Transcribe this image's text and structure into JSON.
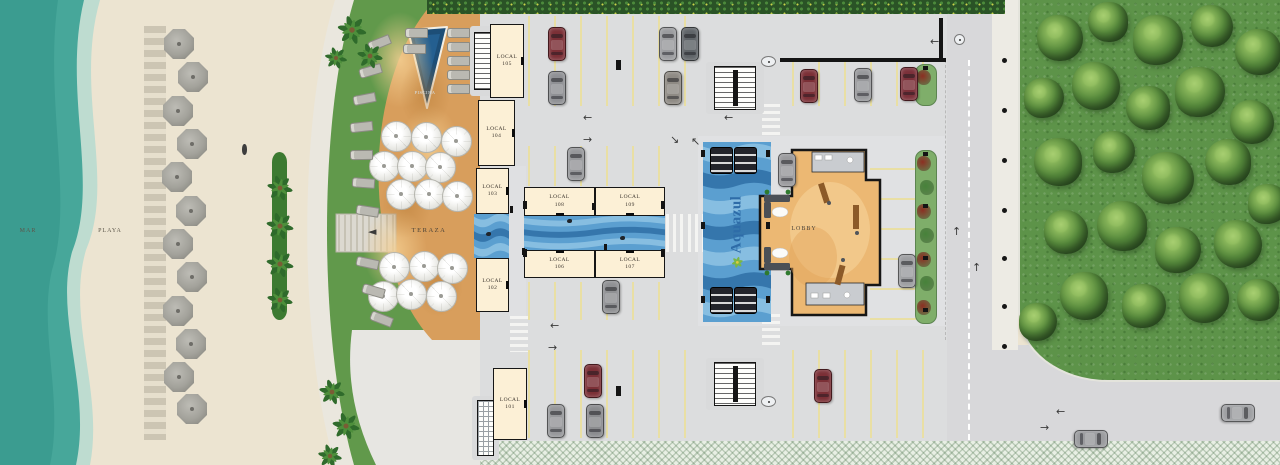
{
  "labels": {
    "sea": "MAR",
    "beach": "PLAYA",
    "terrace": "TERAZA",
    "pool": "PISCINA",
    "lobby": "LOBBY",
    "brand": "Aquazul"
  },
  "colors": {
    "sand": "#ece4d1",
    "seaFoam": "#bedcd0",
    "sea": "#47a79a",
    "seaDeep": "#3b9c90",
    "grass": "#61994b",
    "walkway": "#eae7de",
    "pavement": "#e7e6e2",
    "terrace": "#d89e5c",
    "terraceLight": "#f4cd92",
    "terraceDark": "#c08034",
    "poolTri": "#1d4e77",
    "poolEdge": "#f2efe6",
    "cream": "#fcf0d6",
    "wall": "#161616",
    "asphalt": "#dcddde",
    "stall": "#e9dfa4",
    "waterBase": "#5b9fd0",
    "waveLight": "#8fc3e4",
    "waveDark": "#2f6ea6",
    "lobbyFloor": "#ecb873",
    "lobbySwirl": "#f4cd92",
    "bath": "#c9ccd0",
    "sofa": "#4b5056",
    "wood": "#8c5a28",
    "road": "#d8d8da",
    "sidewalkC": "#edebe4",
    "lawnC": "#5d9349",
    "brandBlue": "#2e6ca8",
    "brandGreen": "#7ab648",
    "brandYellow": "#e2c93f",
    "umbGray": "#a3a29b",
    "treeDark": "#2c5524",
    "treeMid": "#55883b",
    "treeLight": "#8cb95c",
    "planter": "#7fae6a",
    "flowerRed": "#8c2f22",
    "flowerGreen": "#47823a"
  },
  "locals": [
    {
      "name": "LOCAL",
      "num": "105",
      "x": 490,
      "y": 24,
      "w": 34,
      "h": 74,
      "door": "right"
    },
    {
      "name": "LOCAL",
      "num": "104",
      "x": 478,
      "y": 100,
      "w": 37,
      "h": 66,
      "door": "right"
    },
    {
      "name": "LOCAL",
      "num": "103",
      "x": 476,
      "y": 168,
      "w": 33,
      "h": 46,
      "door": "right"
    },
    {
      "name": "LOCAL",
      "num": "102",
      "x": 476,
      "y": 258,
      "w": 33,
      "h": 54,
      "door": "right"
    },
    {
      "name": "LOCAL",
      "num": "101",
      "x": 493,
      "y": 368,
      "w": 34,
      "h": 72,
      "door": "right"
    },
    {
      "name": "LOCAL",
      "num": "108",
      "x": 524,
      "y": 187,
      "w": 71,
      "h": 29,
      "door": "bottom"
    },
    {
      "name": "LOCAL",
      "num": "109",
      "x": 595,
      "y": 187,
      "w": 70,
      "h": 29,
      "door": "bottom"
    },
    {
      "name": "LOCAL",
      "num": "106",
      "x": 524,
      "y": 250,
      "w": 71,
      "h": 28,
      "door": "top"
    },
    {
      "name": "LOCAL",
      "num": "107",
      "x": 595,
      "y": 250,
      "w": 70,
      "h": 28,
      "door": "top"
    }
  ],
  "scene": {
    "water": [
      {
        "x": 474,
        "y": 214,
        "w": 35,
        "h": 44,
        "bands": 3
      },
      {
        "x": 524,
        "y": 216,
        "w": 141,
        "h": 34,
        "bands": 3
      },
      {
        "x": 703,
        "y": 142,
        "w": 68,
        "h": 180,
        "bands": 7
      }
    ],
    "stalls": [
      {
        "x": 528,
        "y": 16,
        "w": 178,
        "h": 90,
        "gap": 26,
        "dir": 90
      },
      {
        "x": 792,
        "y": 62,
        "w": 152,
        "h": 44,
        "gap": 26,
        "dir": 90
      },
      {
        "x": 528,
        "y": 146,
        "w": 138,
        "h": 40,
        "gap": 26,
        "dir": 90
      },
      {
        "x": 528,
        "y": 282,
        "w": 138,
        "h": 38,
        "gap": 26,
        "dir": 90
      },
      {
        "x": 528,
        "y": 350,
        "w": 178,
        "h": 88,
        "gap": 26,
        "dir": 90
      },
      {
        "x": 792,
        "y": 350,
        "w": 152,
        "h": 88,
        "gap": 26,
        "dir": 90
      },
      {
        "x": 870,
        "y": 152,
        "w": 46,
        "h": 168,
        "gap": 30,
        "dir": 0
      }
    ],
    "crosswalks": [
      {
        "x": 762,
        "y": 104,
        "w": 18,
        "h": 34,
        "dir": "h"
      },
      {
        "x": 762,
        "y": 314,
        "w": 18,
        "h": 32,
        "dir": "h"
      },
      {
        "x": 510,
        "y": 316,
        "w": 18,
        "h": 36,
        "dir": "h"
      },
      {
        "x": 666,
        "y": 214,
        "w": 17,
        "h": 38,
        "dir": "v"
      },
      {
        "x": 688,
        "y": 214,
        "w": 17,
        "h": 38,
        "dir": "v"
      }
    ],
    "stairs": [
      {
        "x": 474,
        "y": 32,
        "w": 18,
        "h": 58,
        "type": "treads",
        "px": 470,
        "py": 26,
        "pw": 26,
        "ph": 70
      },
      {
        "x": 714,
        "y": 66,
        "w": 42,
        "h": 44,
        "type": "double",
        "px": 706,
        "py": 62,
        "pw": 58,
        "ph": 52
      },
      {
        "x": 714,
        "y": 362,
        "w": 42,
        "h": 44,
        "type": "double",
        "px": 706,
        "py": 358,
        "pw": 58,
        "ph": 52
      },
      {
        "x": 477,
        "y": 400,
        "w": 17,
        "h": 56,
        "type": "grid",
        "px": 472,
        "py": 396,
        "pw": 27,
        "ph": 64
      }
    ],
    "entry_markers": [
      {
        "x": 761,
        "y": 56,
        "w": 13,
        "h": 9
      },
      {
        "x": 761,
        "y": 396,
        "w": 13,
        "h": 9
      },
      {
        "x": 954,
        "y": 34,
        "w": 9,
        "h": 9
      }
    ],
    "posts": [
      {
        "x": 523,
        "y": 201,
        "w": 4,
        "h": 8
      },
      {
        "x": 523,
        "y": 249,
        "w": 4,
        "h": 8
      },
      {
        "x": 661,
        "y": 201,
        "w": 4,
        "h": 8
      },
      {
        "x": 661,
        "y": 249,
        "w": 4,
        "h": 8
      },
      {
        "x": 592,
        "y": 203,
        "w": 3,
        "h": 7
      },
      {
        "x": 604,
        "y": 244,
        "w": 3,
        "h": 7
      },
      {
        "x": 616,
        "y": 60,
        "w": 5,
        "h": 10
      },
      {
        "x": 616,
        "y": 386,
        "w": 5,
        "h": 10
      },
      {
        "x": 510,
        "y": 206,
        "w": 3,
        "h": 7
      },
      {
        "x": 522,
        "y": 248,
        "w": 3,
        "h": 7
      },
      {
        "x": 780,
        "y": 58,
        "w": 166,
        "h": 4
      },
      {
        "x": 939,
        "y": 18,
        "w": 4,
        "h": 42
      },
      {
        "x": 701,
        "y": 150,
        "w": 4,
        "h": 7
      },
      {
        "x": 701,
        "y": 296,
        "w": 4,
        "h": 7
      },
      {
        "x": 766,
        "y": 150,
        "w": 4,
        "h": 7
      },
      {
        "x": 766,
        "y": 296,
        "w": 4,
        "h": 7
      },
      {
        "x": 701,
        "y": 222,
        "w": 4,
        "h": 7
      },
      {
        "x": 766,
        "y": 222,
        "w": 4,
        "h": 7
      }
    ],
    "benches": [
      {
        "x": 710,
        "y": 147
      },
      {
        "x": 734,
        "y": 147
      },
      {
        "x": 710,
        "y": 287
      },
      {
        "x": 734,
        "y": 287
      }
    ],
    "planters": [
      {
        "x": 915,
        "y": 150,
        "w": 20,
        "h": 172
      },
      {
        "x": 915,
        "y": 64,
        "w": 20,
        "h": 40
      }
    ],
    "cars": [
      {
        "x": 548,
        "y": 27,
        "c": "#7b2f36",
        "rot": 0
      },
      {
        "x": 548,
        "y": 71,
        "c": "#8f9094",
        "rot": 0
      },
      {
        "x": 659,
        "y": 27,
        "c": "#9a9b9e",
        "rot": 0
      },
      {
        "x": 681,
        "y": 27,
        "c": "#5f6468",
        "rot": 0
      },
      {
        "x": 664,
        "y": 71,
        "c": "#8e8a84",
        "rot": 0
      },
      {
        "x": 800,
        "y": 69,
        "c": "#7b2f36",
        "rot": 0
      },
      {
        "x": 854,
        "y": 68,
        "c": "#97989b",
        "rot": 0
      },
      {
        "x": 900,
        "y": 67,
        "c": "#7b3039",
        "rot": 0
      },
      {
        "x": 567,
        "y": 147,
        "c": "#96979a",
        "rot": 0
      },
      {
        "x": 778,
        "y": 153,
        "c": "#9a9a9d",
        "rot": 0
      },
      {
        "x": 602,
        "y": 280,
        "c": "#8f9093",
        "rot": 0
      },
      {
        "x": 584,
        "y": 364,
        "c": "#7b2f36",
        "rot": 0
      },
      {
        "x": 547,
        "y": 404,
        "c": "#96979a",
        "rot": 0
      },
      {
        "x": 586,
        "y": 404,
        "c": "#8a8b8e",
        "rot": 0
      },
      {
        "x": 814,
        "y": 369,
        "c": "#7b2f36",
        "rot": 0
      },
      {
        "x": 898,
        "y": 254,
        "c": "#9d9ea1",
        "rot": 0
      },
      {
        "x": 1082,
        "y": 422,
        "c": "#9a9b9e",
        "rot": 90
      },
      {
        "x": 1229,
        "y": 396,
        "c": "#9fa0a3",
        "rot": 90
      }
    ],
    "arrows": [
      {
        "ch": "←",
        "x": 583,
        "y": 112
      },
      {
        "ch": "→",
        "x": 583,
        "y": 134
      },
      {
        "ch": "←",
        "x": 724,
        "y": 112
      },
      {
        "ch": "←",
        "x": 550,
        "y": 320
      },
      {
        "ch": "→",
        "x": 548,
        "y": 342
      },
      {
        "ch": "↑",
        "x": 952,
        "y": 226
      },
      {
        "ch": "↑",
        "x": 972,
        "y": 262
      },
      {
        "ch": "←",
        "x": 930,
        "y": 36
      },
      {
        "ch": "←",
        "x": 1056,
        "y": 406
      },
      {
        "ch": "→",
        "x": 1040,
        "y": 422
      },
      {
        "ch": "↘",
        "x": 670,
        "y": 134
      },
      {
        "ch": "↖",
        "x": 691,
        "y": 136
      },
      {
        "ch": "◄",
        "x": 368,
        "y": 226
      }
    ],
    "ducks": [
      {
        "x": 567,
        "y": 219
      },
      {
        "x": 620,
        "y": 236
      },
      {
        "x": 486,
        "y": 232
      },
      {
        "x": 728,
        "y": 298
      }
    ],
    "persons": [
      {
        "x": 242,
        "y": 144
      }
    ],
    "beach_umbrellas": [
      {
        "x": 179,
        "y": 44
      },
      {
        "x": 193,
        "y": 77
      },
      {
        "x": 178,
        "y": 111
      },
      {
        "x": 192,
        "y": 144
      },
      {
        "x": 177,
        "y": 177
      },
      {
        "x": 191,
        "y": 211
      },
      {
        "x": 178,
        "y": 244
      },
      {
        "x": 192,
        "y": 277
      },
      {
        "x": 178,
        "y": 311
      },
      {
        "x": 191,
        "y": 344
      },
      {
        "x": 179,
        "y": 377
      },
      {
        "x": 192,
        "y": 409
      }
    ],
    "terrace_umbrellas": [
      {
        "x": 395,
        "y": 135
      },
      {
        "x": 425,
        "y": 136
      },
      {
        "x": 455,
        "y": 140
      },
      {
        "x": 383,
        "y": 165
      },
      {
        "x": 411,
        "y": 165
      },
      {
        "x": 439,
        "y": 166
      },
      {
        "x": 400,
        "y": 193
      },
      {
        "x": 428,
        "y": 193
      },
      {
        "x": 456,
        "y": 195
      },
      {
        "x": 393,
        "y": 266
      },
      {
        "x": 423,
        "y": 265
      },
      {
        "x": 451,
        "y": 267
      },
      {
        "x": 382,
        "y": 295
      },
      {
        "x": 410,
        "y": 293
      },
      {
        "x": 440,
        "y": 295
      }
    ],
    "loungers": [
      {
        "x": 368,
        "y": 38,
        "r": -22
      },
      {
        "x": 359,
        "y": 66,
        "r": -16
      },
      {
        "x": 353,
        "y": 94,
        "r": -11
      },
      {
        "x": 350,
        "y": 122,
        "r": -6
      },
      {
        "x": 350,
        "y": 150,
        "r": -1
      },
      {
        "x": 352,
        "y": 178,
        "r": 4
      },
      {
        "x": 356,
        "y": 206,
        "r": 9
      },
      {
        "x": 356,
        "y": 258,
        "r": 12
      },
      {
        "x": 362,
        "y": 286,
        "r": 16
      },
      {
        "x": 370,
        "y": 314,
        "r": 21
      },
      {
        "x": 447,
        "y": 28,
        "r": 0
      },
      {
        "x": 447,
        "y": 42,
        "r": 0
      },
      {
        "x": 447,
        "y": 56,
        "r": 0
      },
      {
        "x": 447,
        "y": 70,
        "r": 0
      },
      {
        "x": 447,
        "y": 84,
        "r": 0
      },
      {
        "x": 405,
        "y": 28,
        "r": 0
      },
      {
        "x": 403,
        "y": 44,
        "r": 0
      }
    ],
    "palms": [
      {
        "x": 280,
        "y": 188,
        "s": 30
      },
      {
        "x": 280,
        "y": 226,
        "s": 32
      },
      {
        "x": 280,
        "y": 264,
        "s": 32
      },
      {
        "x": 280,
        "y": 300,
        "s": 30
      },
      {
        "x": 352,
        "y": 30,
        "s": 34
      },
      {
        "x": 370,
        "y": 56,
        "s": 30
      },
      {
        "x": 336,
        "y": 58,
        "s": 26
      },
      {
        "x": 332,
        "y": 392,
        "s": 30
      },
      {
        "x": 346,
        "y": 426,
        "s": 32
      },
      {
        "x": 330,
        "y": 456,
        "s": 28
      }
    ],
    "trees": [
      {
        "x": 1060,
        "y": 38,
        "d": 46
      },
      {
        "x": 1108,
        "y": 22,
        "d": 40
      },
      {
        "x": 1158,
        "y": 40,
        "d": 50
      },
      {
        "x": 1212,
        "y": 26,
        "d": 42
      },
      {
        "x": 1258,
        "y": 52,
        "d": 46
      },
      {
        "x": 1044,
        "y": 98,
        "d": 40
      },
      {
        "x": 1096,
        "y": 86,
        "d": 48
      },
      {
        "x": 1148,
        "y": 108,
        "d": 44
      },
      {
        "x": 1200,
        "y": 92,
        "d": 50
      },
      {
        "x": 1252,
        "y": 122,
        "d": 44
      },
      {
        "x": 1058,
        "y": 162,
        "d": 48
      },
      {
        "x": 1114,
        "y": 152,
        "d": 42
      },
      {
        "x": 1168,
        "y": 178,
        "d": 52
      },
      {
        "x": 1228,
        "y": 162,
        "d": 46
      },
      {
        "x": 1268,
        "y": 204,
        "d": 40
      },
      {
        "x": 1066,
        "y": 232,
        "d": 44
      },
      {
        "x": 1122,
        "y": 226,
        "d": 50
      },
      {
        "x": 1178,
        "y": 250,
        "d": 46
      },
      {
        "x": 1238,
        "y": 244,
        "d": 48
      },
      {
        "x": 1084,
        "y": 296,
        "d": 48
      },
      {
        "x": 1144,
        "y": 306,
        "d": 44
      },
      {
        "x": 1204,
        "y": 298,
        "d": 50
      },
      {
        "x": 1258,
        "y": 300,
        "d": 42
      },
      {
        "x": 1038,
        "y": 322,
        "d": 38
      }
    ],
    "bollards": [
      58,
      108,
      158,
      208,
      256,
      304,
      344
    ],
    "swirls": [
      {
        "x": 400,
        "y": 60,
        "w": 66,
        "h": 96,
        "c": "rgba(244,207,146,.85)"
      },
      {
        "x": 430,
        "y": 150,
        "w": 60,
        "h": 90,
        "c": "rgba(244,207,146,.8)"
      },
      {
        "x": 395,
        "y": 250,
        "w": 64,
        "h": 86,
        "c": "rgba(244,207,146,.8)"
      },
      {
        "x": 425,
        "y": 95,
        "w": 50,
        "h": 70,
        "c": "rgba(180,120,50,.45)"
      },
      {
        "x": 405,
        "y": 205,
        "w": 52,
        "h": 66,
        "c": "rgba(180,120,50,.45)"
      },
      {
        "x": 438,
        "y": 285,
        "w": 50,
        "h": 64,
        "c": "rgba(180,120,50,.45)"
      }
    ]
  }
}
